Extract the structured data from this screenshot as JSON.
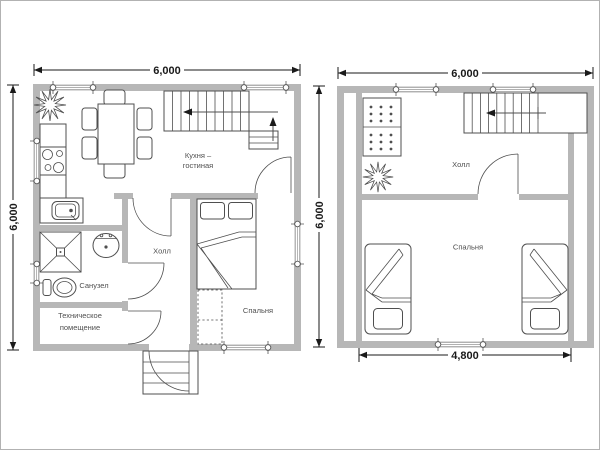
{
  "document": {
    "type": "house-floor-plan-drawing",
    "sheets": 2
  },
  "colors": {
    "wall": "#b7b7b7",
    "line": "#4f4f4f",
    "dimension": "#1a1a1a",
    "background": "#ffffff"
  },
  "plan1": {
    "title": "first-floor-plan",
    "dim_top": "6,000",
    "dim_left": "6,000",
    "rooms": {
      "kitchen_line1": "Кухня –",
      "kitchen_line2": "гостиная",
      "hall": "Холл",
      "bathroom": "Санузел",
      "tech_line1": "Техническое",
      "tech_line2": "помещение",
      "bedroom": "Спальня"
    }
  },
  "plan2": {
    "title": "second-floor-plan",
    "dim_top": "6,000",
    "dim_left": "6,000",
    "dim_bottom": "4,800",
    "rooms": {
      "hall": "Холл",
      "bedroom": "Спальня"
    }
  },
  "icons": {
    "plant": "star-flower houseplant symbol",
    "stove": "four-burner cooktop",
    "kitchen_sink": "counter with sink basin",
    "shower": "square tray with diagonals",
    "washbasin": "oval basin with taps",
    "toilet": "toilet with tank",
    "dining_set": "table with six chairs",
    "stairs": "stair flight with direction arrow",
    "double_bed": "double bed with pillows and folded blanket",
    "single_bed": "single bed with pillow and folded blanket",
    "wardrobe": "dashed wardrobe block",
    "sofa": "two dotted cushions",
    "door": "quarter-circle swing arc",
    "window": "wall opening with tie markers",
    "entrance_steps": "outside step block"
  }
}
